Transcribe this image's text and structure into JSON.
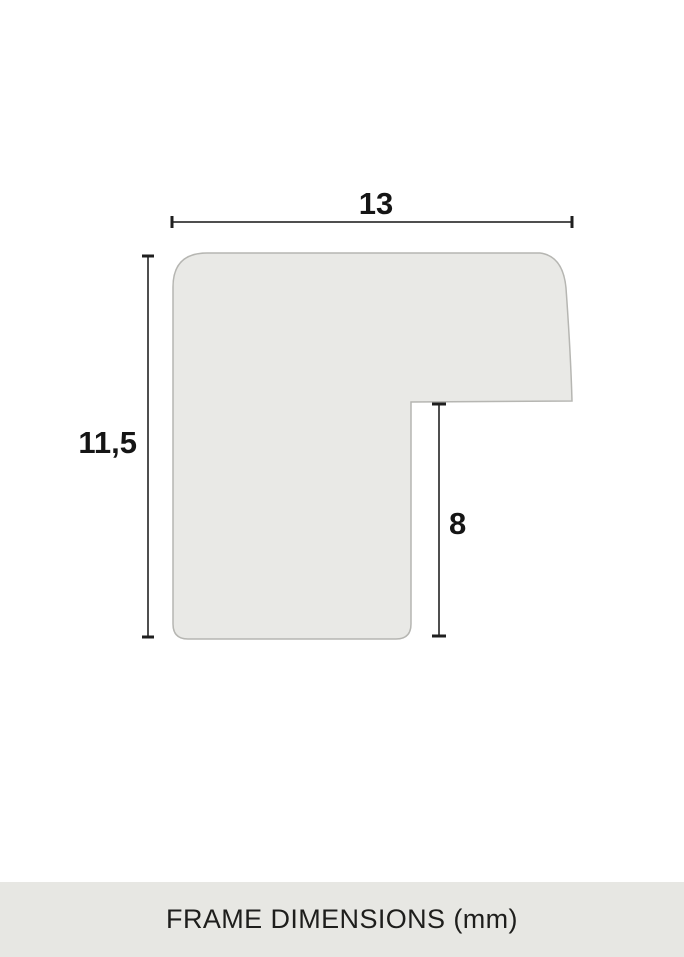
{
  "diagram": {
    "width_label": "13",
    "height_label": "11,5",
    "rabbet_label": "8"
  },
  "footer": {
    "caption": "FRAME DIMENSIONS (mm)"
  },
  "colors": {
    "background": "#ffffff",
    "profile_fill": "#e9e9e6",
    "profile_stroke": "#b6b6b2",
    "dimension_line": "#4f4f4f",
    "tick": "#1f1f1f",
    "label_text": "#151515",
    "footer_bg": "#e7e7e3",
    "footer_text": "#1e1e1c"
  }
}
